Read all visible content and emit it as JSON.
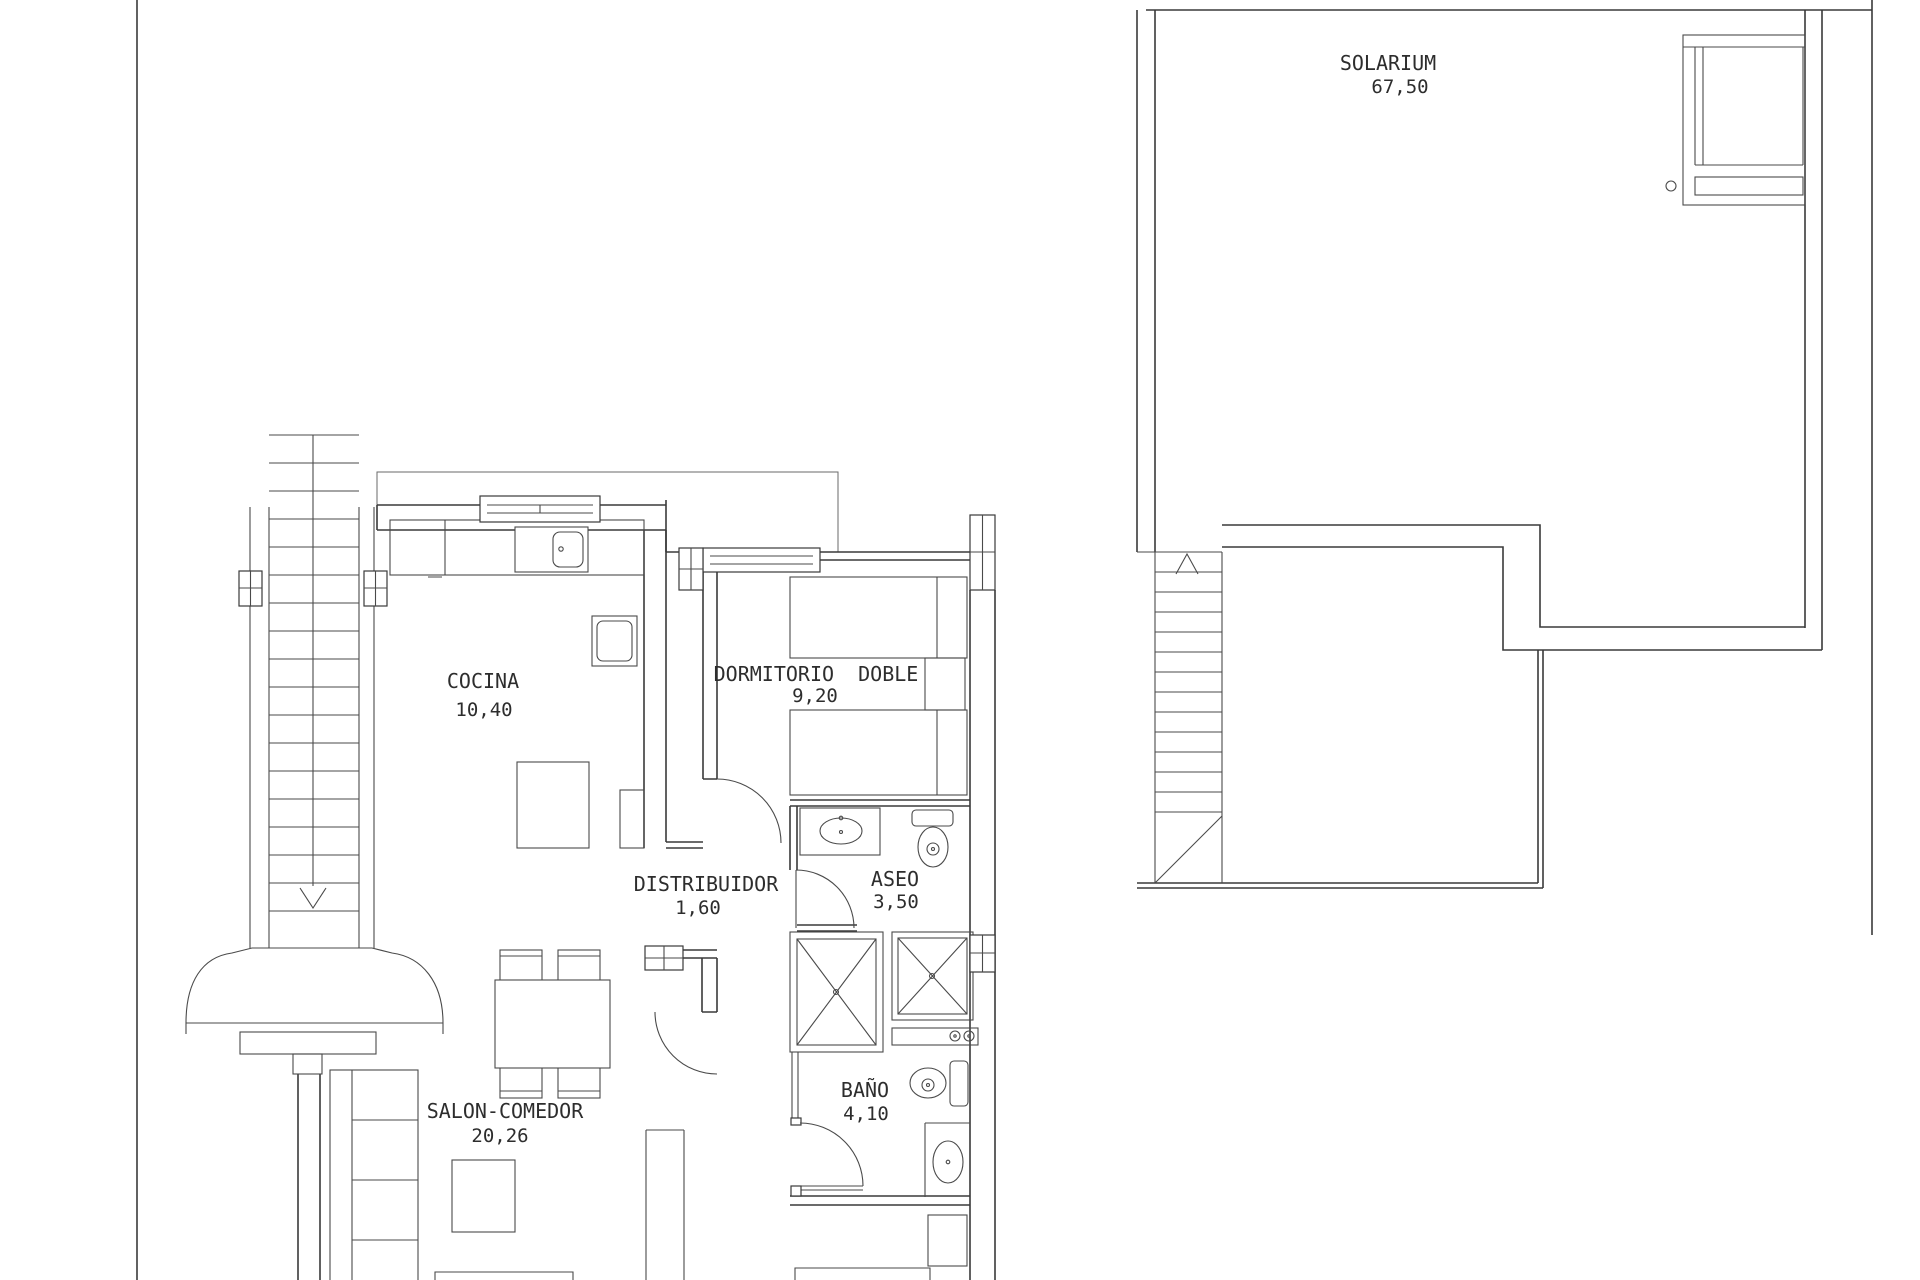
{
  "document": {
    "kind": "architectural floor plan, two plans side by side"
  },
  "rooms": {
    "solarium": {
      "name": "SOLARIUM",
      "area": "67,50"
    },
    "cocina": {
      "name": "COCINA",
      "area": "10,40"
    },
    "dormitorio_doble": {
      "name": "DORMITORIO  DOBLE",
      "area": "9,20"
    },
    "distribuidor": {
      "name": "DISTRIBUIDOR",
      "area": "1,60"
    },
    "aseo": {
      "name": "ASEO",
      "area": "3,50"
    },
    "bano": {
      "name": "BAÑO",
      "area": "4,10"
    },
    "salon_comedor": {
      "name": "SALON-COMEDOR",
      "area": "20,26"
    }
  }
}
